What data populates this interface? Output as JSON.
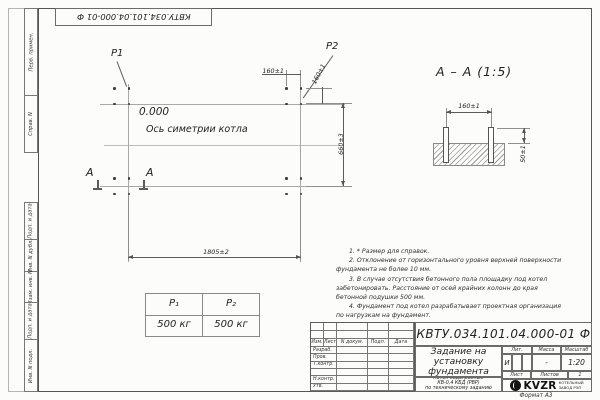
{
  "page": {
    "format_label": "Формат А3"
  },
  "top_stamp": "КВТУ.034.101.04.000-01 Ф",
  "margin": {
    "top": [
      "Перв. примен.",
      "Справ. N"
    ],
    "bottom": [
      "Подп. и дата",
      "Инв. N дубл.",
      "Взам. инв. N",
      "Подп. и дата",
      "Инв. N подл."
    ]
  },
  "plan": {
    "p1": "Р1",
    "p2": "Р2",
    "elevation": "0.000",
    "axis": "Ось симетрии котла",
    "dim_width": "1805±2",
    "dim_height": "660±3",
    "dim_offset_h": "160±1",
    "dim_offset_v": "160±1",
    "section_mark": "А"
  },
  "section": {
    "title": "А – А (1:5)",
    "dim_span": "160±1",
    "dim_protrusion": "50±1"
  },
  "loads": {
    "headers": [
      "Р₁",
      "Р₂"
    ],
    "values": [
      "500 кг",
      "500 кг"
    ]
  },
  "notes": [
    "1. * Размер для справок.",
    "2. Отклонение от горизонтального уровня верхней поверхности фундамента не более 10 мм.",
    "3. В случае отсутствия бетонного пола площадку под котел забетонировать. Расстояние от осей крайних колонн до края бетонной подушки 500 мм.",
    "4. Фундамент под котел разрабатывает проектная организация по нагрузкам на фундамент."
  ],
  "title_block": {
    "designation": "КВТУ.034.101.04.000-01 Ф",
    "doc_title_lines": [
      "Задание на",
      "установку",
      "фундамента"
    ],
    "product_lines": [
      "Котел водогрейный",
      "КВ-0,4 КБД (РВР)",
      "по техническому заданию"
    ],
    "header_cols": [
      "Изм.",
      "Лист",
      "N докум.",
      "Подп.",
      "Дата"
    ],
    "rows": [
      "Разраб.",
      "Пров.",
      "Т.контр.",
      "",
      "Н.контр.",
      "Утв."
    ],
    "lit_label": "Лит.",
    "mass_label": "Масса",
    "scale_label": "Масштаб",
    "lit_value": "И",
    "mass_value": "-",
    "scale_value": "1:20",
    "sheet_label": "Лист",
    "sheets_label": "Листов",
    "sheets_value": "1",
    "logo_text": "KVZR",
    "logo_sub_lines": [
      "КОТЕЛЬНЫЙ",
      "ЗАВОД РЭП"
    ]
  }
}
